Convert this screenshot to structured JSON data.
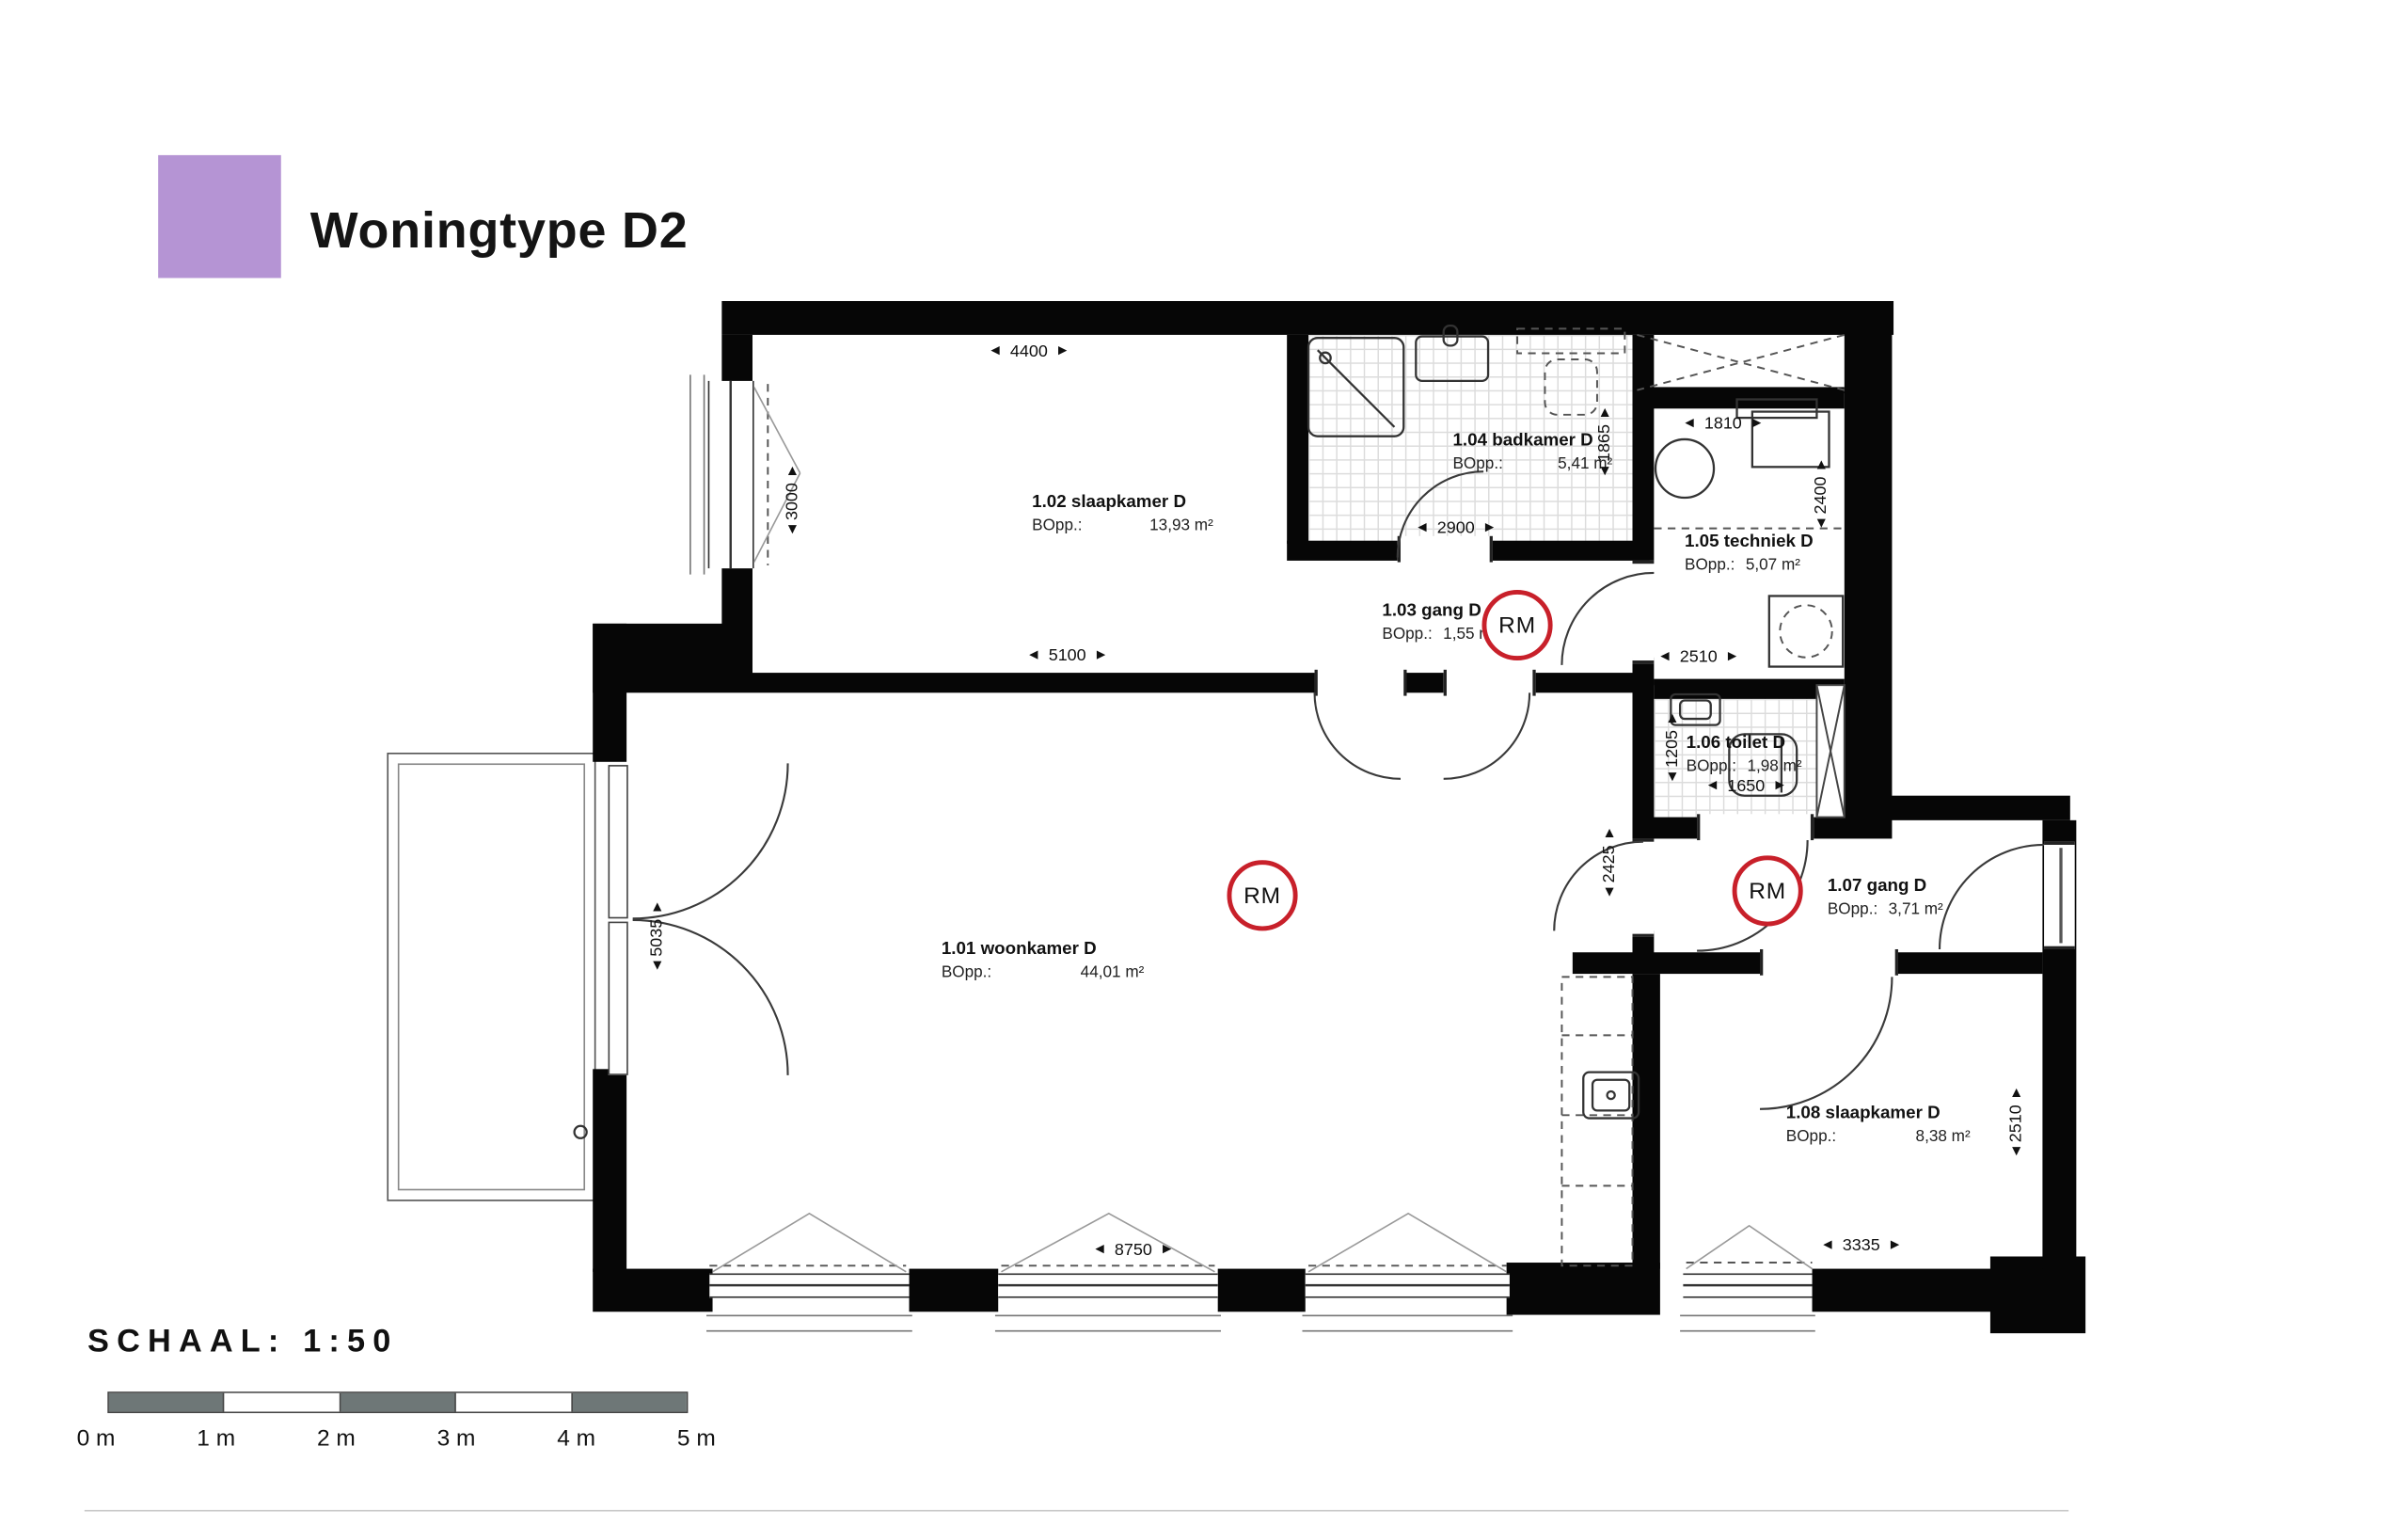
{
  "header": {
    "title": "Woningtype D2",
    "legend_color": "#b594d4"
  },
  "rooms": [
    {
      "name": "1.01 woonkamer D",
      "bopp_label": "BOpp.:",
      "area": "44,01 m²"
    },
    {
      "name": "1.02 slaapkamer D",
      "bopp_label": "BOpp.:",
      "area": "13,93 m²"
    },
    {
      "name": "1.03 gang D",
      "bopp_label": "BOpp.:",
      "area": "1,55 m²"
    },
    {
      "name": "1.04 badkamer D",
      "bopp_label": "BOpp.:",
      "area": "5,41 m²"
    },
    {
      "name": "1.05 techniek D",
      "bopp_label": "BOpp.:",
      "area": "5,07 m²"
    },
    {
      "name": "1.06 toilet D",
      "bopp_label": "BOpp.:",
      "area": "1,98 m²"
    },
    {
      "name": "1.07 gang D",
      "bopp_label": "BOpp.:",
      "area": "3,71 m²"
    },
    {
      "name": "1.08 slaapkamer D",
      "bopp_label": "BOpp.:",
      "area": "8,38 m²"
    }
  ],
  "dims": [
    "4400",
    "3000",
    "5100",
    "2900",
    "1865",
    "1810",
    "2400",
    "2510",
    "1205",
    "1650",
    "2425",
    "5035",
    "8750",
    "3335",
    "2510"
  ],
  "markers": {
    "smoke_detector_label": "RM",
    "smoke_detector_color": "#c8202a"
  },
  "icons": {
    "arrow_left": "◄",
    "arrow_right": "►",
    "arrow_up": "▲",
    "arrow_down": "▼"
  },
  "scale_bar": {
    "title": "SCHAAL:  1:50",
    "labels": [
      "0 m",
      "1 m",
      "2 m",
      "3 m",
      "4 m",
      "5 m"
    ],
    "bar_dark": "#6e7777"
  }
}
